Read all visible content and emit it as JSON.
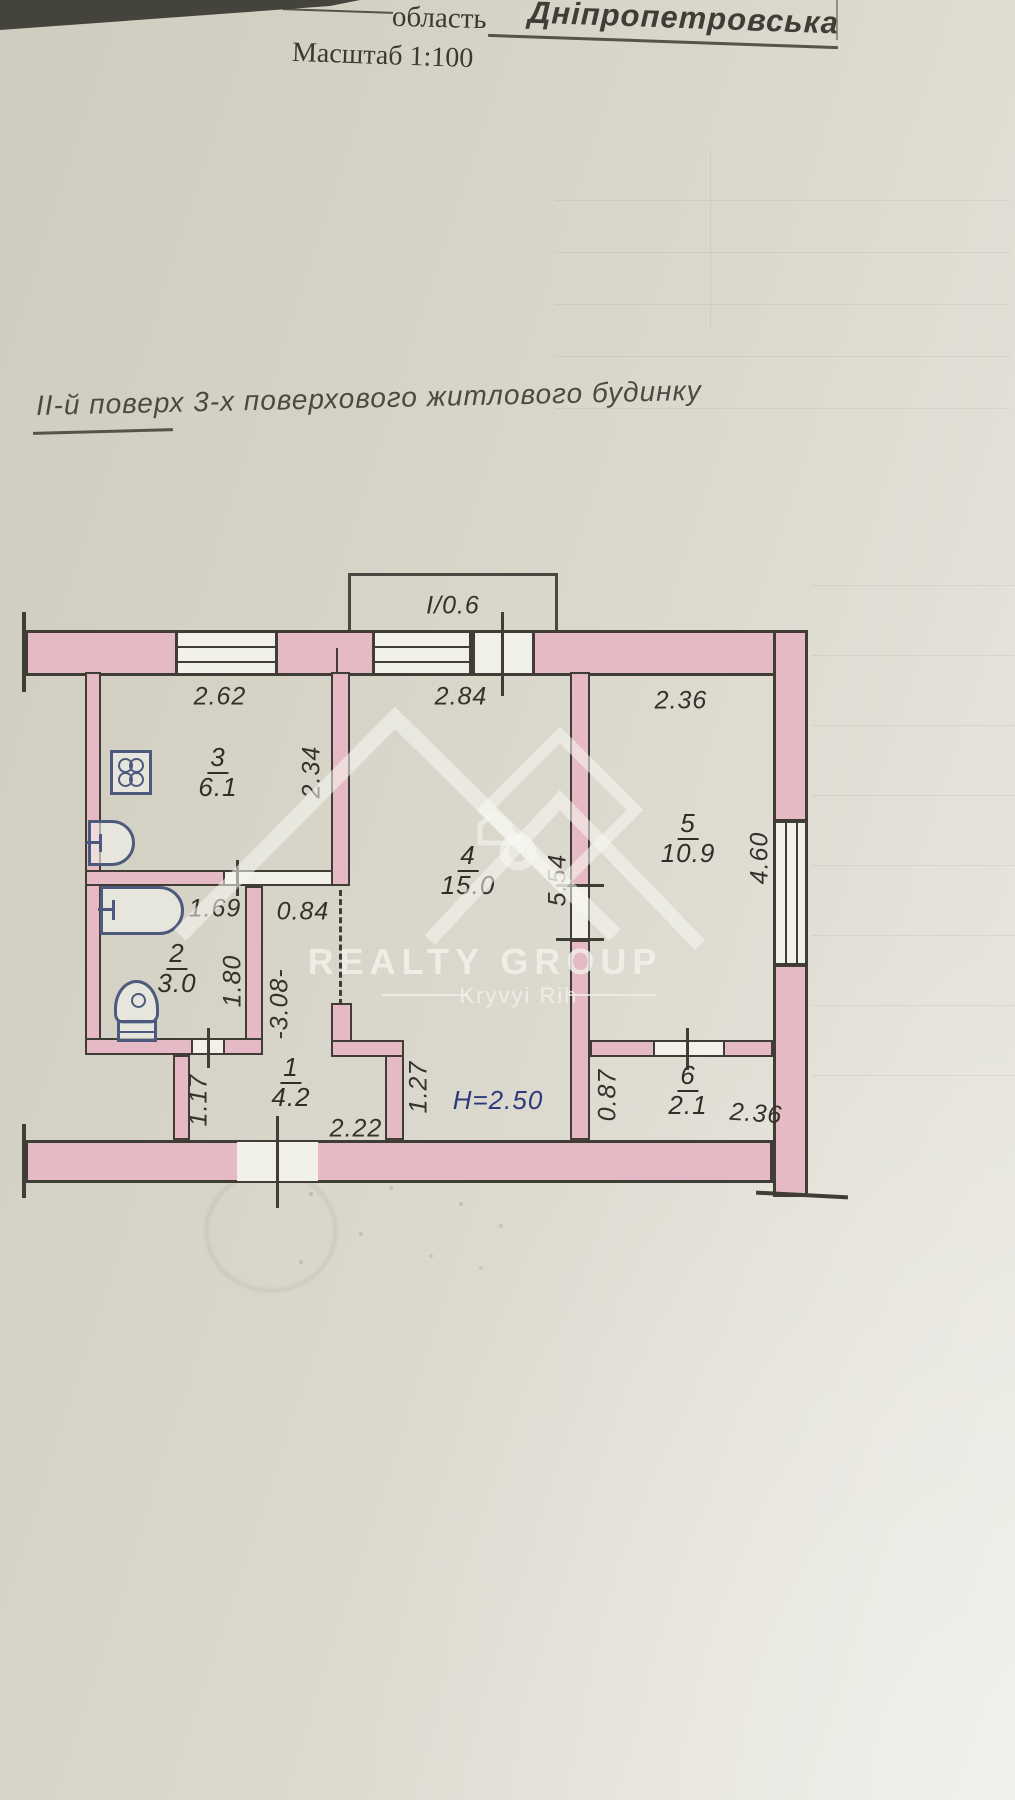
{
  "header": {
    "region_label": "область",
    "region_value": "Дніпропетровська",
    "scale_text": "Масштаб 1:100"
  },
  "title": "ІІ-й поверх 3-х поверхового житлового будинку",
  "watermark": {
    "brand": "REALTY GROUP",
    "city": "Kryvyi Rih"
  },
  "plan": {
    "balcony_label": "І/0.6",
    "ceiling_height": "Н=2.50",
    "rooms": [
      {
        "number": "1",
        "area": "4.2"
      },
      {
        "number": "2",
        "area": "3.0"
      },
      {
        "number": "3",
        "area": "6.1"
      },
      {
        "number": "4",
        "area": "15.0"
      },
      {
        "number": "5",
        "area": "10.9"
      },
      {
        "number": "6",
        "area": "2.1"
      }
    ],
    "dimensions": {
      "top_kitchen": "2.62",
      "top_room4": "2.84",
      "top_room5": "2.36",
      "kitchen_depth": "2.34",
      "bath_width": "1.69",
      "passage": "0.84",
      "bath_depth": "1.80",
      "hall_span": "-3.08-",
      "hall_left": "1.17",
      "hall_width": "2.22",
      "room4_depth": "5.54",
      "room5_depth": "4.60",
      "step": "1.27",
      "room6_depth": "0.87",
      "room6_width": "2.36"
    }
  },
  "colors": {
    "wall_fill": "#e6bac4",
    "line": "#3f3d36",
    "height_note": "#2e3a7c"
  }
}
